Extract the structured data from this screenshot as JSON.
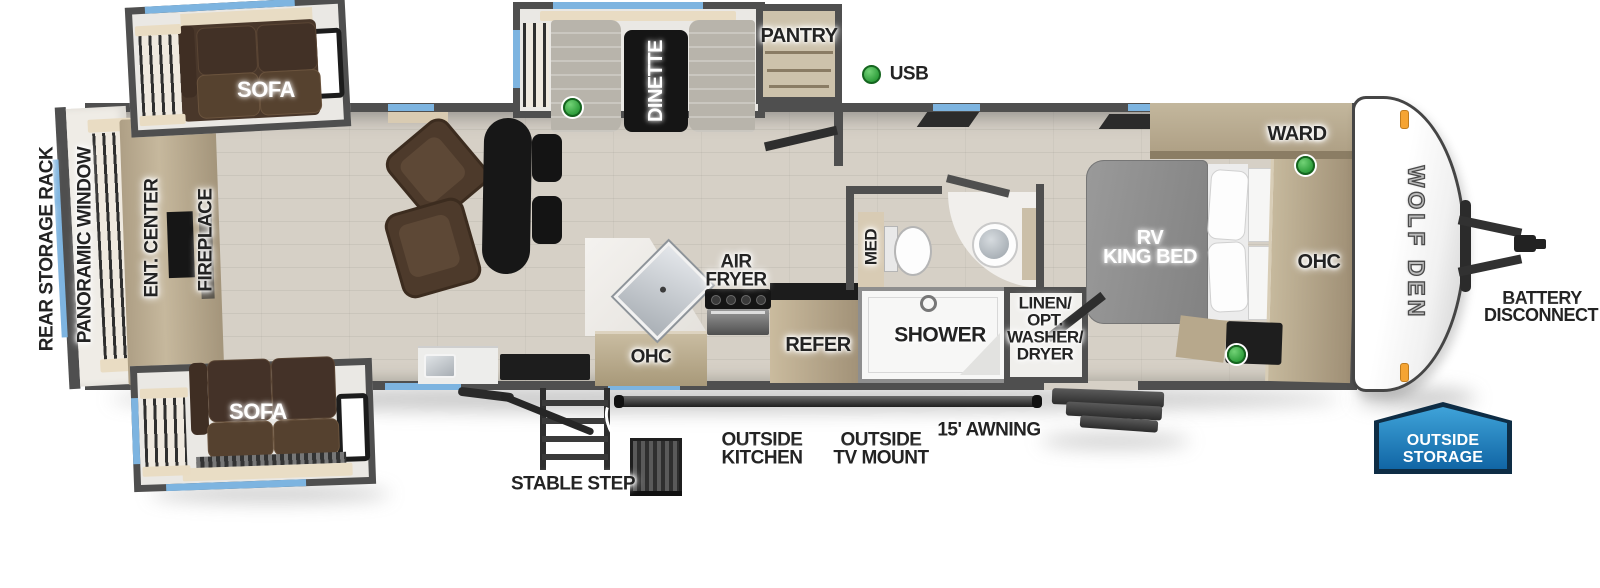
{
  "title": "Wolf Den travel trailer floorplan",
  "logo": "WOLF DEN",
  "interior": {
    "rear_storage_rack": "REAR STORAGE RACK",
    "panoramic_window": "PANORAMIC WINDOW",
    "ent_center": "ENT. CENTER",
    "fireplace": "FIREPLACE",
    "sofa_top": "SOFA",
    "sofa_bottom": "SOFA",
    "dinette": "DINETTE",
    "pantry": "PANTRY",
    "usb": "USB",
    "air_fryer": [
      "AIR",
      "FRYER"
    ],
    "ohc_kitchen": "OHC",
    "refer": "REFER",
    "med": "MED",
    "shower": "SHOWER",
    "linen": [
      "LINEN/",
      "OPT.",
      "WASHER/",
      "DRYER"
    ],
    "rv_king_bed": [
      "RV",
      "KING BED"
    ],
    "ward": "WARD",
    "ohc_bedroom": "OHC"
  },
  "exterior": {
    "battery_disconnect": [
      "BATTERY",
      "DISCONNECT"
    ],
    "outside_storage": [
      "OUTSIDE",
      "STORAGE"
    ],
    "outside_kitchen": [
      "OUTSIDE",
      "KITCHEN"
    ],
    "outside_tv_mount": [
      "OUTSIDE",
      "TV MOUNT"
    ],
    "awning": "15' AWNING",
    "stable_step": "STABLE STEP"
  },
  "colors": {
    "wall": "#4f4f4f",
    "floor_wood": "#d6d0c6",
    "window_blue": "#7db4e0",
    "cabinet_tan": "#b9ab90",
    "sofa_brown": "#49372a",
    "usb_green": "#3fae49",
    "badge_blue": "#1a79b5",
    "slide_floor": "#eae8e4",
    "bed_gray": "#8e8e8e"
  }
}
